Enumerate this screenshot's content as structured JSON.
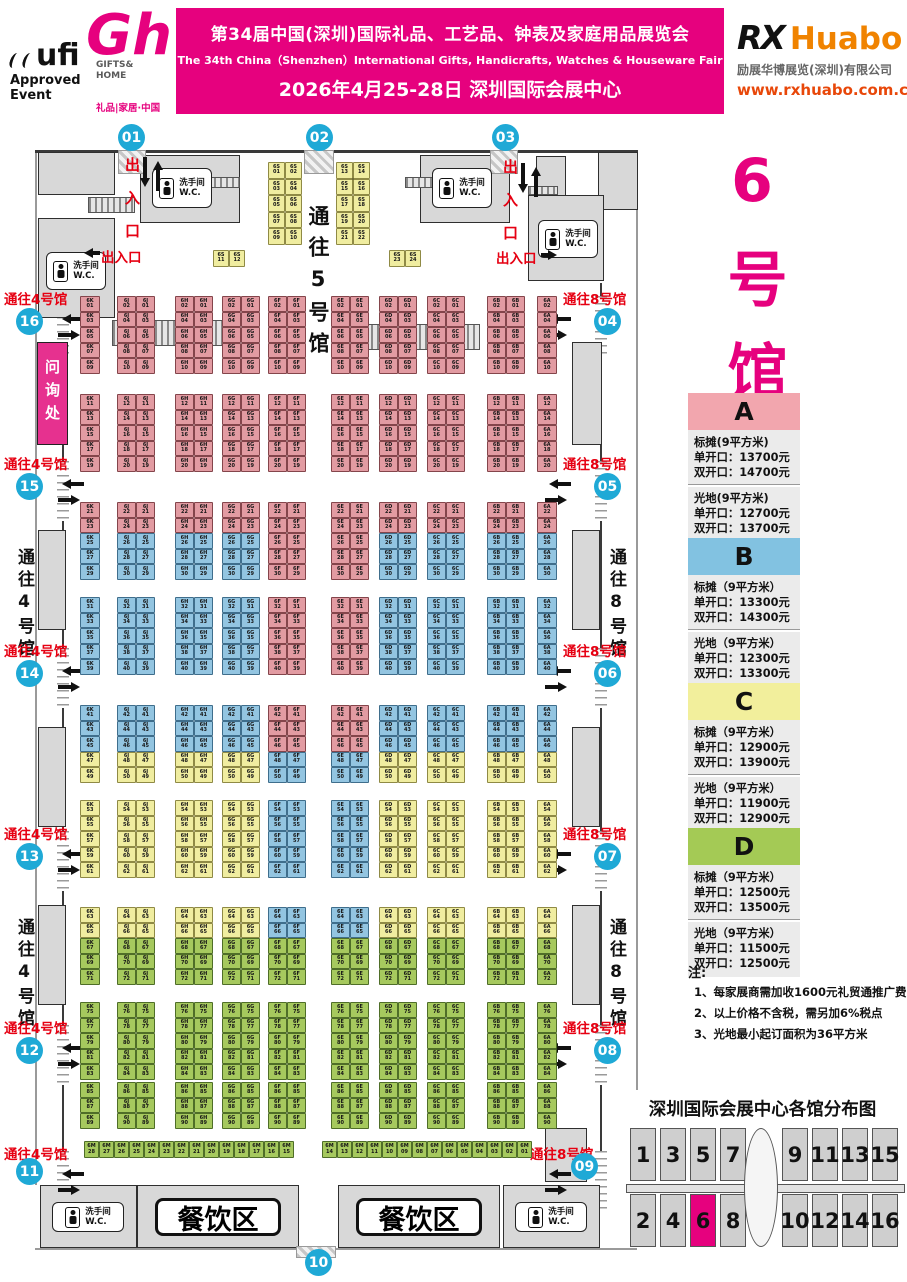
{
  "header": {
    "ufi_logo": "ufi",
    "ufi_sub1": "Approved",
    "ufi_sub2": "Event",
    "gh_glyph": "Gh",
    "gh_name1": "GIFTS&",
    "gh_name2": "HOME",
    "gh_tagline": "礼品|家居·中国",
    "banner_title": "第34届中国(深圳)国际礼品、工艺品、钟表及家庭用品展览会",
    "banner_subtitle": "The 34th China（Shenzhen）International Gifts, Handicrafts, Watches & Houseware Fair",
    "banner_date": "2026年4月25-28日 深圳国际会展中心",
    "banner_color": "#E6017E",
    "rx_mark": "RX",
    "rx_brand": "Huabo",
    "rx_company": "励展华博展览(深圳)有限公司",
    "rx_site": "www.rxhuabo.com.cn"
  },
  "hall_title": "6号馆",
  "legend": [
    {
      "id": "A",
      "header_color": "#F2A6AE",
      "std_title": "标摊(9平方米)",
      "std1": "单开口：13700元",
      "std2": "双开口：14700元",
      "raw_title": "光地(9平方米)",
      "raw1": "单开口：12700元",
      "raw2": "双开口：13700元"
    },
    {
      "id": "B",
      "header_color": "#82C2E1",
      "std_title": "标摊（9平方米）",
      "std1": "单开口：13300元",
      "std2": "双开口：14300元",
      "raw_title": "光地（9平方米）",
      "raw1": "单开口：12300元",
      "raw2": "双开口：13300元"
    },
    {
      "id": "C",
      "header_color": "#F2EF9C",
      "std_title": "标摊（9平方米）",
      "std1": "单开口：12900元",
      "std2": "双开口：13900元",
      "raw_title": "光地（9平方米）",
      "raw1": "单开口：11900元",
      "raw2": "双开口：12900元"
    },
    {
      "id": "D",
      "header_color": "#A4CA55",
      "std_title": "标摊（9平方米）",
      "std1": "单开口：12500元",
      "std2": "双开口：13500元",
      "raw_title": "光地（9平方米）",
      "raw1": "单开口：11500元",
      "raw2": "双开口：12500元"
    }
  ],
  "notes": {
    "label": "注:",
    "items": [
      "1、每家展商需加收1600元礼贸通推广费",
      "2、以上价格不含税，需另加6%税点",
      "3、光地最小起订面积为36平方米"
    ]
  },
  "distribution": {
    "title": "深圳国际会展中心各馆分布图",
    "top": [
      "1",
      "3",
      "5",
      "7",
      "9",
      "11",
      "13",
      "15"
    ],
    "bottom": [
      "2",
      "4",
      "6",
      "8",
      "10",
      "12",
      "14",
      "16"
    ],
    "highlight": "6",
    "highlight_color": "#E6017E"
  },
  "plan": {
    "entry": "出入口",
    "info_desk": "问询处",
    "wc_line1": "洗手间",
    "wc_line2": "W.C.",
    "dining": "餐饮区",
    "aisle5": "通往5号馆",
    "to4": "通往4号馆",
    "to8": "通往8号馆",
    "booth_colors": {
      "A": {
        "fill": "#E29BA2",
        "line": "#84454B"
      },
      "B": {
        "fill": "#93C5E1",
        "line": "#3F6E8C"
      },
      "C": {
        "fill": "#F0EDA0",
        "line": "#8F8A45"
      },
      "D": {
        "fill": "#A6C95E",
        "line": "#4F6E28"
      }
    },
    "circle_color": "#1FA9D6",
    "top_gates": [
      {
        "num": "01",
        "x": 118
      },
      {
        "num": "02",
        "x": 306
      },
      {
        "num": "03",
        "x": 492
      }
    ],
    "bottom_gate": {
      "num": "10",
      "x": 305,
      "y": 1249
    },
    "left_gates": [
      {
        "num": "16",
        "y": 288
      },
      {
        "num": "15",
        "y": 453
      },
      {
        "num": "14",
        "y": 640
      },
      {
        "num": "13",
        "y": 823
      },
      {
        "num": "12",
        "y": 1017
      },
      {
        "num": "11",
        "y": 1143,
        "cy": 1158
      }
    ],
    "right_gates": [
      {
        "num": "04",
        "y": 288
      },
      {
        "num": "05",
        "y": 453
      },
      {
        "num": "06",
        "y": 640
      },
      {
        "num": "07",
        "y": 823
      },
      {
        "num": "08",
        "y": 1017
      },
      {
        "num": "09",
        "y": 1143,
        "lx": 530,
        "cx": 571,
        "cy": 1153
      }
    ],
    "corridor_text_ys": [
      548,
      918
    ],
    "grid": {
      "cell_h": 15.5,
      "special_cols": [
        4,
        5
      ],
      "columns": [
        {
          "prefix": "6K",
          "x": 80,
          "type": "single",
          "parity": "odd"
        },
        {
          "prefix": "6J",
          "x": 117,
          "type": "double"
        },
        {
          "prefix": "6H",
          "x": 175,
          "type": "double"
        },
        {
          "prefix": "6G",
          "x": 222,
          "type": "double"
        },
        {
          "prefix": "6F",
          "x": 268,
          "type": "double"
        },
        {
          "prefix": "6E",
          "x": 331,
          "type": "double"
        },
        {
          "prefix": "6D",
          "x": 379,
          "type": "double"
        },
        {
          "prefix": "6C",
          "x": 427,
          "type": "double"
        },
        {
          "prefix": "6B",
          "x": 487,
          "type": "double"
        },
        {
          "prefix": "6A",
          "x": 537,
          "type": "single",
          "parity": "even"
        }
      ],
      "bands": [
        {
          "y": 296,
          "start": 1,
          "rows": 5,
          "colors": [
            "A",
            "A",
            "A",
            "A",
            "A"
          ]
        },
        {
          "y": 394,
          "start": 11,
          "rows": 5,
          "colors": [
            "A",
            "A",
            "A",
            "A",
            "A"
          ]
        },
        {
          "y": 502,
          "start": 21,
          "rows": 5,
          "colors": [
            "A",
            "A",
            "B",
            "B",
            "B"
          ],
          "special": [
            "A",
            "A",
            "A",
            "A",
            "A"
          ]
        },
        {
          "y": 597,
          "start": 31,
          "rows": 5,
          "colors": [
            "B",
            "B",
            "B",
            "B",
            "B"
          ],
          "special": [
            "A",
            "A",
            "A",
            "A",
            "A"
          ]
        },
        {
          "y": 705,
          "start": 41,
          "rows": 5,
          "colors": [
            "B",
            "B",
            "B",
            "C",
            "C"
          ],
          "special": [
            "A",
            "A",
            "A",
            "B",
            "B"
          ]
        },
        {
          "y": 800,
          "start": 53,
          "rows": 5,
          "colors": [
            "C",
            "C",
            "C",
            "C",
            "C"
          ],
          "special": [
            "B",
            "B",
            "B",
            "B",
            "B"
          ]
        },
        {
          "y": 907,
          "start": 63,
          "rows": 5,
          "colors": [
            "C",
            "C",
            "D",
            "D",
            "D"
          ],
          "special": [
            "B",
            "B",
            "D",
            "D",
            "D"
          ]
        },
        {
          "y": 1002,
          "start": 75,
          "rows": 5,
          "colors": [
            "D",
            "D",
            "D",
            "D",
            "D"
          ]
        },
        {
          "y": 1082,
          "start": 85,
          "rows": 3,
          "colors": [
            "D",
            "D",
            "D"
          ]
        }
      ]
    },
    "top_blocks": [
      {
        "prefix": "6S",
        "x": 268,
        "y": 162,
        "rows": 5,
        "start": 1
      },
      {
        "prefix": "6S",
        "x": 336,
        "y": 162,
        "rows": 5,
        "start": 13
      }
    ],
    "top_pairs": [
      {
        "prefix": "6S",
        "x": 213,
        "y": 250,
        "n1": 11,
        "n2": 12
      },
      {
        "prefix": "6S",
        "x": 389,
        "y": 250,
        "n1": 23,
        "n2": 24
      }
    ],
    "m_strip": {
      "prefix": "6M",
      "y": 1141,
      "left_x": 84,
      "right_x": 322,
      "left_from": 28,
      "left_to": 15,
      "right_from": 14,
      "right_to": 1
    }
  }
}
